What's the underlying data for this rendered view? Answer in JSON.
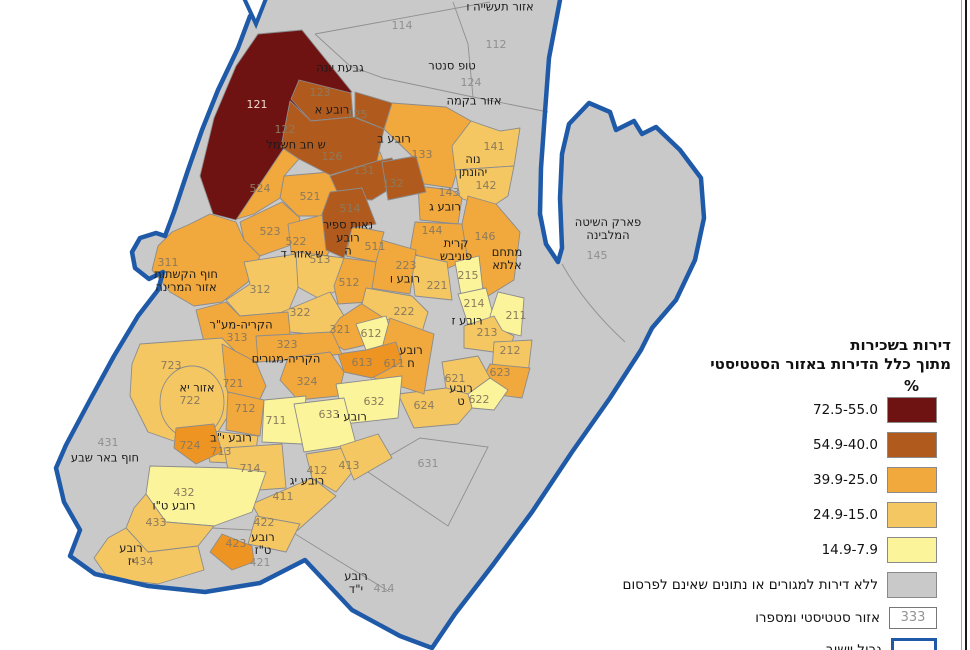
{
  "legend": {
    "title_line1": "דירות בשכירות",
    "title_line2": "מתוך כלל הדירות באזור הסטטיסטי",
    "unit": "%",
    "classes": [
      {
        "range": "72.5-55.0",
        "color": "#6e1312"
      },
      {
        "range": "54.9-40.0",
        "color": "#b05a1e"
      },
      {
        "range": "39.9-25.0",
        "color": "#f1a83c"
      },
      {
        "range": "24.9-15.0",
        "color": "#f4c763"
      },
      {
        "range": "14.9-7.9",
        "color": "#fbf49b"
      }
    ],
    "no_data": {
      "label": "ללא דירות למגורים או נתונים שאינם לפרסום",
      "color": "#c9c9c9"
    },
    "stat_area": {
      "label": "אזור סטטיסטי ומספרו",
      "sample": "333"
    },
    "boundary": {
      "label": "גבול יישוב",
      "color": "#1f5aa8"
    }
  },
  "colors": {
    "dark_red": "#6e1312",
    "brown": "#b05a1e",
    "orange": "#f1a83c",
    "orange_deep": "#ee9422",
    "tan": "#f4c763",
    "yellow": "#fbf49b",
    "no_data_gray": "#c9c9c9",
    "boundary_blue": "#1f5aa8"
  },
  "map": {
    "labels": [
      {
        "t": "121",
        "x": 257,
        "y": 105,
        "c": "w"
      },
      {
        "t": "122",
        "x": 285,
        "y": 130,
        "c": "n"
      },
      {
        "t": "123",
        "x": 320,
        "y": 93,
        "c": "n"
      },
      {
        "t": "125",
        "x": 357,
        "y": 115,
        "c": "n"
      },
      {
        "t": "126",
        "x": 332,
        "y": 157,
        "c": "n"
      },
      {
        "t": "131",
        "x": 364,
        "y": 171,
        "c": "n"
      },
      {
        "t": "132",
        "x": 393,
        "y": 184,
        "c": "n"
      },
      {
        "t": "133",
        "x": 422,
        "y": 155,
        "c": "n"
      },
      {
        "t": "141",
        "x": 494,
        "y": 147,
        "c": "n"
      },
      {
        "t": "142",
        "x": 486,
        "y": 186,
        "c": "n"
      },
      {
        "t": "143",
        "x": 449,
        "y": 193,
        "c": "n"
      },
      {
        "t": "144",
        "x": 432,
        "y": 231,
        "c": "n"
      },
      {
        "t": "146",
        "x": 485,
        "y": 237,
        "c": "n"
      },
      {
        "t": "145",
        "x": 597,
        "y": 256,
        "c": "g"
      },
      {
        "t": "112",
        "x": 496,
        "y": 45,
        "c": "g"
      },
      {
        "t": "114",
        "x": 402,
        "y": 26,
        "c": "g"
      },
      {
        "t": "124",
        "x": 471,
        "y": 83,
        "c": "g"
      },
      {
        "t": "524",
        "x": 260,
        "y": 189,
        "c": "n"
      },
      {
        "t": "523",
        "x": 270,
        "y": 232,
        "c": "n"
      },
      {
        "t": "522",
        "x": 296,
        "y": 242,
        "c": "n"
      },
      {
        "t": "521",
        "x": 310,
        "y": 197,
        "c": "n"
      },
      {
        "t": "514",
        "x": 350,
        "y": 209,
        "c": "n"
      },
      {
        "t": "513",
        "x": 320,
        "y": 260,
        "c": "n"
      },
      {
        "t": "511",
        "x": 375,
        "y": 247,
        "c": "n"
      },
      {
        "t": "512",
        "x": 349,
        "y": 283,
        "c": "n"
      },
      {
        "t": "311",
        "x": 168,
        "y": 263,
        "c": "n"
      },
      {
        "t": "312",
        "x": 260,
        "y": 290,
        "c": "n"
      },
      {
        "t": "313",
        "x": 237,
        "y": 338,
        "c": "n"
      },
      {
        "t": "322",
        "x": 300,
        "y": 313,
        "c": "n"
      },
      {
        "t": "321",
        "x": 340,
        "y": 330,
        "c": "n"
      },
      {
        "t": "323",
        "x": 287,
        "y": 345,
        "c": "n"
      },
      {
        "t": "324",
        "x": 307,
        "y": 382,
        "c": "n"
      },
      {
        "t": "223",
        "x": 406,
        "y": 266,
        "c": "n"
      },
      {
        "t": "221",
        "x": 437,
        "y": 286,
        "c": "n"
      },
      {
        "t": "222",
        "x": 404,
        "y": 312,
        "c": "n"
      },
      {
        "t": "215",
        "x": 468,
        "y": 276,
        "c": "n"
      },
      {
        "t": "214",
        "x": 474,
        "y": 304,
        "c": "n"
      },
      {
        "t": "213",
        "x": 487,
        "y": 333,
        "c": "n"
      },
      {
        "t": "211",
        "x": 516,
        "y": 316,
        "c": "n"
      },
      {
        "t": "212",
        "x": 510,
        "y": 351,
        "c": "n"
      },
      {
        "t": "612",
        "x": 371,
        "y": 334,
        "c": "n"
      },
      {
        "t": "613",
        "x": 362,
        "y": 363,
        "c": "n"
      },
      {
        "t": "611",
        "x": 394,
        "y": 364,
        "c": "n"
      },
      {
        "t": "621",
        "x": 455,
        "y": 379,
        "c": "n"
      },
      {
        "t": "622",
        "x": 479,
        "y": 400,
        "c": "n"
      },
      {
        "t": "623",
        "x": 500,
        "y": 373,
        "c": "n"
      },
      {
        "t": "624",
        "x": 424,
        "y": 406,
        "c": "n"
      },
      {
        "t": "631",
        "x": 428,
        "y": 464,
        "c": "g"
      },
      {
        "t": "632",
        "x": 374,
        "y": 402,
        "c": "n"
      },
      {
        "t": "633",
        "x": 329,
        "y": 415,
        "c": "n"
      },
      {
        "t": "721",
        "x": 233,
        "y": 384,
        "c": "n"
      },
      {
        "t": "722",
        "x": 190,
        "y": 401,
        "c": "n"
      },
      {
        "t": "723",
        "x": 171,
        "y": 366,
        "c": "n"
      },
      {
        "t": "724",
        "x": 190,
        "y": 446,
        "c": "n"
      },
      {
        "t": "711",
        "x": 276,
        "y": 421,
        "c": "n"
      },
      {
        "t": "712",
        "x": 245,
        "y": 409,
        "c": "n"
      },
      {
        "t": "713",
        "x": 221,
        "y": 452,
        "c": "n"
      },
      {
        "t": "714",
        "x": 250,
        "y": 469,
        "c": "n"
      },
      {
        "t": "411",
        "x": 283,
        "y": 497,
        "c": "n"
      },
      {
        "t": "412",
        "x": 317,
        "y": 471,
        "c": "n"
      },
      {
        "t": "413",
        "x": 349,
        "y": 466,
        "c": "n"
      },
      {
        "t": "414",
        "x": 384,
        "y": 589,
        "c": "g"
      },
      {
        "t": "421",
        "x": 260,
        "y": 563,
        "c": "g"
      },
      {
        "t": "422",
        "x": 264,
        "y": 523,
        "c": "n"
      },
      {
        "t": "423",
        "x": 236,
        "y": 544,
        "c": "n"
      },
      {
        "t": "431",
        "x": 108,
        "y": 443,
        "c": "g"
      },
      {
        "t": "432",
        "x": 184,
        "y": 493,
        "c": "n"
      },
      {
        "t": "433",
        "x": 156,
        "y": 523,
        "c": "n"
      },
      {
        "t": "434",
        "x": 143,
        "y": 562,
        "c": "n"
      },
      {
        "t": "אזור תעשייה ו",
        "x": 500,
        "y": 7,
        "c": "t"
      },
      {
        "t": "טופ סנטר",
        "x": 452,
        "y": 66,
        "c": "t"
      },
      {
        "t": "גבעת יונה",
        "x": 340,
        "y": 68,
        "c": "t"
      },
      {
        "t": "אזור בקמה",
        "x": 474,
        "y": 101,
        "c": "t"
      },
      {
        "t": "רובע א",
        "x": 332,
        "y": 110,
        "c": "t"
      },
      {
        "t": "ש חב חשמל",
        "x": 296,
        "y": 145,
        "c": "t"
      },
      {
        "t": "רובע ב",
        "x": 394,
        "y": 139,
        "c": "t"
      },
      {
        "t": "נוה\nיהונתן",
        "x": 473,
        "y": 166,
        "c": "t"
      },
      {
        "t": "רובע ג",
        "x": 445,
        "y": 207,
        "c": "t"
      },
      {
        "t": "קרית\nפוניבש",
        "x": 456,
        "y": 250,
        "c": "t"
      },
      {
        "t": "מתחם\nאלתא",
        "x": 507,
        "y": 259,
        "c": "t"
      },
      {
        "t": "פארק השיטה\nהמלבינה",
        "x": 608,
        "y": 229,
        "c": "t"
      },
      {
        "t": "נאות ספיר\nרובע\nה",
        "x": 348,
        "y": 238,
        "c": "t"
      },
      {
        "t": "ש אזור ד",
        "x": 302,
        "y": 254,
        "c": "t"
      },
      {
        "t": "חוף הקשתות\nאזור המרינה",
        "x": 186,
        "y": 281,
        "c": "t"
      },
      {
        "t": "הקריה-מע\"ר",
        "x": 241,
        "y": 325,
        "c": "t"
      },
      {
        "t": "רובע ו",
        "x": 405,
        "y": 279,
        "c": "t"
      },
      {
        "t": "רובע ז",
        "x": 467,
        "y": 321,
        "c": "t"
      },
      {
        "t": "רובע\nח",
        "x": 411,
        "y": 357,
        "c": "t"
      },
      {
        "t": "רובע\nט",
        "x": 461,
        "y": 395,
        "c": "t"
      },
      {
        "t": "הקריה-מגורים",
        "x": 286,
        "y": 359,
        "c": "t"
      },
      {
        "t": "אזור יא",
        "x": 197,
        "y": 388,
        "c": "t"
      },
      {
        "t": "רובע י\"ב",
        "x": 231,
        "y": 438,
        "c": "t"
      },
      {
        "t": "רובע י",
        "x": 352,
        "y": 417,
        "c": "t"
      },
      {
        "t": "רובע יג",
        "x": 307,
        "y": 481,
        "c": "t"
      },
      {
        "t": "חוף באר שבע",
        "x": 105,
        "y": 458,
        "c": "t"
      },
      {
        "t": "רובע ט\"ו",
        "x": 174,
        "y": 506,
        "c": "t"
      },
      {
        "t": "רובע\nיז",
        "x": 131,
        "y": 555,
        "c": "t"
      },
      {
        "t": "רובע\nט\"ז",
        "x": 263,
        "y": 544,
        "c": "t"
      },
      {
        "t": "רובע\nי\"ד",
        "x": 356,
        "y": 583,
        "c": "t"
      }
    ]
  }
}
